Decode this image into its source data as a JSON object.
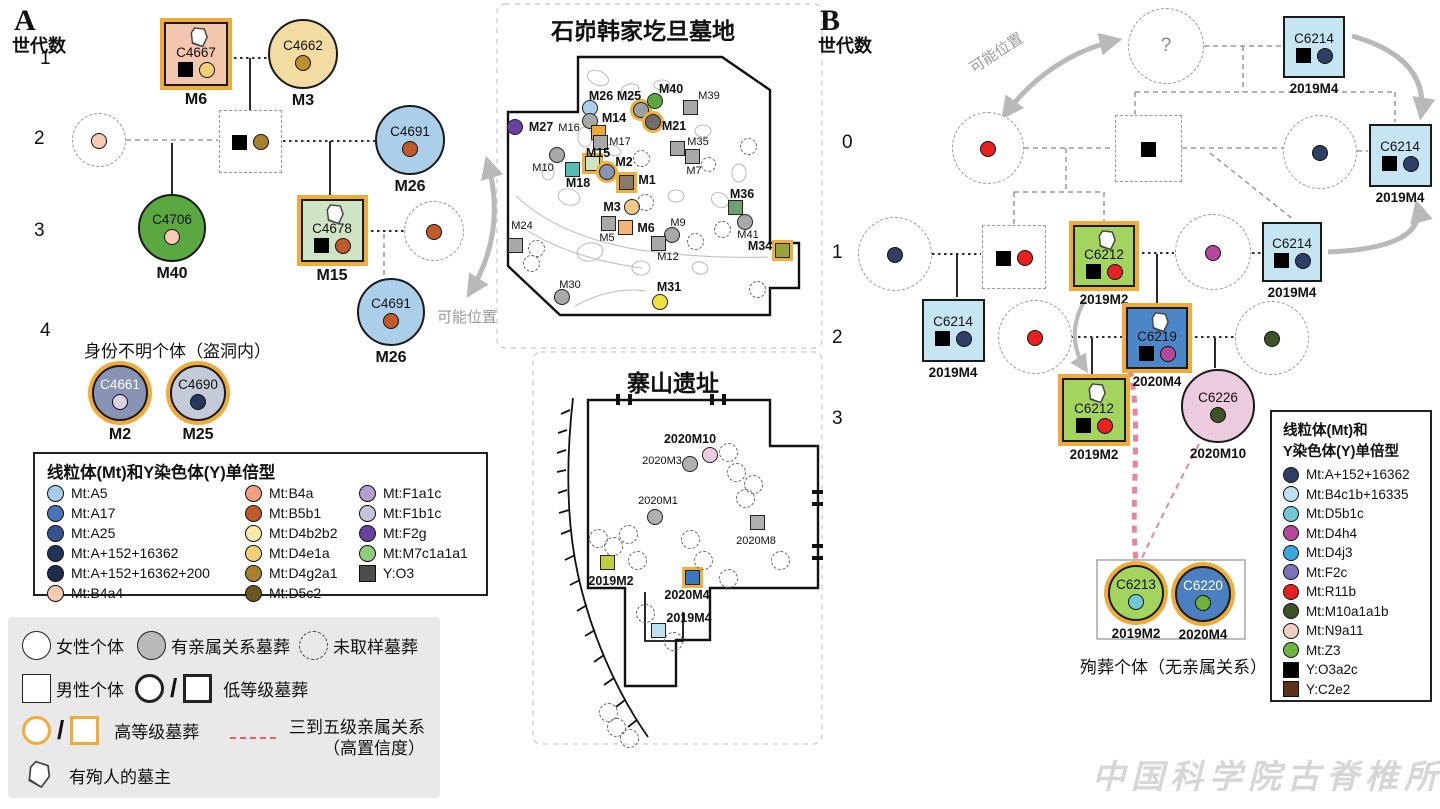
{
  "panelA": {
    "letter": "A",
    "axis_label": "世代数",
    "generations": [
      "1",
      "2",
      "3",
      "4"
    ],
    "unknown_group_label": "身份不明个体（盗洞内）",
    "possible_position_label": "可能位置"
  },
  "panelB": {
    "letter": "B",
    "axis_label": "世代数",
    "generations": [
      "0",
      "1",
      "2",
      "3"
    ],
    "possible_position_label": "可能位置",
    "sacrifice_caption": "殉葬个体（无亲属关系）"
  },
  "nodesA": [
    {
      "id": "C4667",
      "tomb": "M6",
      "shape": "sq",
      "x": 196,
      "y": 54,
      "s": 64,
      "fill": "#f3c6ae",
      "ring": true,
      "jar": true,
      "ysq": true,
      "dot": "#f2d176"
    },
    {
      "id": "C4662",
      "tomb": "M3",
      "shape": "ci",
      "x": 303,
      "y": 54,
      "s": 70,
      "fill": "#f3dca2",
      "dot": "#bd8e2e"
    },
    {
      "shape": "ci",
      "dashed": true,
      "x": 99,
      "y": 140,
      "s": 54,
      "dot": "#f7cab3"
    },
    {
      "shape": "sq",
      "dashed": true,
      "x": 250,
      "y": 141,
      "s": 63,
      "ysq": true,
      "dot": "#a9802e"
    },
    {
      "id": "C4691",
      "tomb": "M26",
      "shape": "ci",
      "x": 410,
      "y": 140,
      "s": 70,
      "fill": "#abceeb",
      "dot": "#c15a2a"
    },
    {
      "id": "C4706",
      "tomb": "M40",
      "shape": "ci",
      "x": 172,
      "y": 228,
      "s": 68,
      "fill": "#5aa83f",
      "dot": "#f7cab3"
    },
    {
      "id": "C4678",
      "tomb": "M15",
      "shape": "sq",
      "x": 332,
      "y": 230,
      "s": 63,
      "fill": "#cfe4c5",
      "ring": true,
      "jar": true,
      "ysq": true,
      "dot": "#c15a2a"
    },
    {
      "shape": "ci",
      "dashed": true,
      "x": 434,
      "y": 231,
      "s": 60,
      "dot": "#c15a2a"
    },
    {
      "id": "C4691",
      "tomb": "M26",
      "shape": "ci",
      "x": 391,
      "y": 312,
      "s": 68,
      "fill": "#abceeb",
      "dot": "#c15a2a"
    },
    {
      "id": "C4661",
      "tomb": "M2",
      "shape": "ci",
      "x": 120,
      "y": 393,
      "s": 56,
      "fill": "#8893b6",
      "ring": true,
      "dot": "#d9d2e4",
      "light": true
    },
    {
      "id": "C4690",
      "tomb": "M25",
      "shape": "ci",
      "x": 198,
      "y": 393,
      "s": 56,
      "fill": "#c4cbd8",
      "ring": true,
      "dot": "#26365c"
    }
  ],
  "nodesB": [
    {
      "q": "?",
      "shape": "ci",
      "dashed": true,
      "x": 1166,
      "y": 46,
      "s": 76
    },
    {
      "id": "C6214",
      "tomb": "2019M4",
      "shape": "sq",
      "x": 1314,
      "y": 47,
      "s": 62,
      "fill": "#c6e5f3",
      "ysq": true,
      "dot": "#2e3f66"
    },
    {
      "shape": "ci",
      "dashed": true,
      "x": 988,
      "y": 148,
      "s": 72,
      "dot": "#e8201f"
    },
    {
      "shape": "sq",
      "dashed": true,
      "x": 1148,
      "y": 148,
      "s": 67,
      "ysq": true
    },
    {
      "shape": "ci",
      "dashed": true,
      "x": 1320,
      "y": 152,
      "s": 74,
      "dot": "#2e3f66"
    },
    {
      "id": "C6214",
      "tomb": "2019M4",
      "shape": "sq",
      "x": 1400,
      "y": 155,
      "s": 63,
      "fill": "#c6e5f3",
      "ysq": true,
      "dot": "#2e3f66"
    },
    {
      "shape": "ci",
      "dashed": true,
      "x": 895,
      "y": 254,
      "s": 74,
      "dot": "#2e3f66"
    },
    {
      "shape": "sq",
      "dashed": true,
      "x": 1014,
      "y": 257,
      "s": 64,
      "ysq": true,
      "dot": "#e8201f"
    },
    {
      "id": "C6212",
      "tomb": "2019M2",
      "shape": "sq",
      "x": 1104,
      "y": 256,
      "s": 62,
      "fill": "#a2d45e",
      "ring": true,
      "jar": true,
      "ysq": true,
      "dot": "#e8201f"
    },
    {
      "shape": "ci",
      "dashed": true,
      "x": 1213,
      "y": 252,
      "s": 76,
      "dot": "#b5489b"
    },
    {
      "id": "C6214",
      "tomb": "2019M4",
      "shape": "sq",
      "x": 1292,
      "y": 252,
      "s": 60,
      "fill": "#c6e5f3",
      "ysq": true,
      "dot": "#2e3f66"
    },
    {
      "id": "C6214",
      "tomb": "2019M4",
      "shape": "sq",
      "x": 953,
      "y": 330,
      "s": 63,
      "fill": "#c6e5f3",
      "ysq": true,
      "dot": "#2e3f66"
    },
    {
      "shape": "ci",
      "dashed": true,
      "x": 1035,
      "y": 337,
      "s": 74,
      "dot": "#e8201f"
    },
    {
      "id": "C6219",
      "tomb": "2020M4",
      "shape": "sq",
      "x": 1157,
      "y": 338,
      "s": 62,
      "fill": "#4a86c8",
      "ring": true,
      "jar": true,
      "ysq": true,
      "dot": "#b5489b"
    },
    {
      "shape": "ci",
      "dashed": true,
      "x": 1272,
      "y": 338,
      "s": 74,
      "dot": "#3f5328"
    },
    {
      "id": "C6226",
      "tomb": "2020M10",
      "shape": "ci",
      "x": 1218,
      "y": 406,
      "s": 74,
      "fill": "#edcbdf",
      "dot": "#3f5328"
    },
    {
      "id": "C6212",
      "tomb": "2019M2",
      "shape": "sq",
      "x": 1094,
      "y": 410,
      "s": 64,
      "fill": "#a2d45e",
      "ring": true,
      "jar": true,
      "ysq": true,
      "dot": "#e8201f"
    },
    {
      "id": "C6213",
      "tomb": "2019M2",
      "shape": "ci",
      "x": 1136,
      "y": 593,
      "s": 56,
      "fill": "#a2d45e",
      "ring": true,
      "dot": "#6fc9d4"
    },
    {
      "id": "C6220",
      "tomb": "2020M4",
      "shape": "ci",
      "x": 1203,
      "y": 594,
      "s": 56,
      "fill": "#4a7fc0",
      "ring": true,
      "dot": "#6db33f",
      "light": true
    }
  ],
  "mapA": {
    "title": "石峁韩家圪旦墓地",
    "markers": [
      {
        "id": "M26",
        "shape": "ci",
        "x": 590,
        "y": 108,
        "fill": "#abceeb",
        "lx": 601,
        "ly": 96,
        "bold": true
      },
      {
        "id": "M25",
        "shape": "ci",
        "x": 641,
        "y": 110,
        "fill": "#9aa0a6",
        "ring": true,
        "lx": 629,
        "ly": 96,
        "bold": true
      },
      {
        "id": "M40",
        "shape": "ci",
        "x": 655,
        "y": 101,
        "fill": "#5aa83f",
        "lx": 671,
        "ly": 89,
        "bold": true
      },
      {
        "id": "M39",
        "shape": "sq",
        "x": 690,
        "y": 107,
        "fill": "#a8a8a8",
        "lx": 709,
        "ly": 96
      },
      {
        "id": "M27",
        "shape": "ci",
        "x": 515,
        "y": 127,
        "fill": "#6a3f9e",
        "lx": 541,
        "ly": 127,
        "bold": true
      },
      {
        "id": "M16",
        "shape": "ci",
        "x": 590,
        "y": 121,
        "fill": "#a8a8a8",
        "lx": 569,
        "ly": 128
      },
      {
        "id": "M14",
        "shape": "sq",
        "x": 598,
        "y": 132,
        "fill": "#f0a832",
        "lx": 614,
        "ly": 118,
        "bold": true
      },
      {
        "id": "M17",
        "shape": "sq",
        "x": 600,
        "y": 142,
        "fill": "#a8a8a8",
        "lx": 620,
        "ly": 142
      },
      {
        "id": "M21",
        "shape": "ci",
        "x": 653,
        "y": 122,
        "fill": "#6e6e6e",
        "ring": true,
        "lx": 674,
        "ly": 126,
        "bold": true
      },
      {
        "id": "M35",
        "shape": "sq",
        "x": 677,
        "y": 148,
        "fill": "#a8a8a8",
        "lx": 698,
        "ly": 142
      },
      {
        "id": "",
        "shape": "sq",
        "x": 692,
        "y": 156,
        "fill": "#a8a8a8",
        "lx": 0,
        "ly": 0
      },
      {
        "id": "M15",
        "shape": "sq",
        "x": 592,
        "y": 163,
        "fill": "#cfe4c5",
        "ring": true,
        "lx": 598,
        "ly": 153,
        "bold": true
      },
      {
        "id": "M2",
        "shape": "ci",
        "x": 607,
        "y": 172,
        "fill": "#8893b6",
        "ring": true,
        "lx": 624,
        "ly": 162,
        "bold": true
      },
      {
        "id": "M10",
        "shape": "ci",
        "x": 557,
        "y": 155,
        "fill": "#a8a8a8",
        "lx": 543,
        "ly": 168
      },
      {
        "id": "M18",
        "shape": "sq",
        "x": 572,
        "y": 169,
        "fill": "#57bdb2",
        "lx": 578,
        "ly": 183,
        "bold": true
      },
      {
        "id": "M1",
        "shape": "sq",
        "x": 626,
        "y": 182,
        "fill": "#8a7a6a",
        "ring": true,
        "lx": 647,
        "ly": 180,
        "bold": true
      },
      {
        "id": "M7",
        "shape": "dash",
        "x": 708,
        "y": 164,
        "lx": 694,
        "ly": 171
      },
      {
        "id": "M36",
        "shape": "sq",
        "x": 735,
        "y": 207,
        "fill": "#6f9e6f",
        "lx": 742,
        "ly": 194,
        "bold": true
      },
      {
        "id": "M3",
        "shape": "ci",
        "x": 632,
        "y": 207,
        "fill": "#f5c98a",
        "lx": 612,
        "ly": 207,
        "bold": true
      },
      {
        "id": "M24",
        "shape": "sq",
        "x": 515,
        "y": 245,
        "fill": "#a8a8a8",
        "lx": 522,
        "ly": 226
      },
      {
        "id": "M5",
        "shape": "sq",
        "x": 608,
        "y": 223,
        "fill": "#a8a8a8",
        "lx": 607,
        "ly": 238
      },
      {
        "id": "M6",
        "shape": "sq",
        "x": 625,
        "y": 227,
        "fill": "#f5b57a",
        "lx": 646,
        "ly": 228,
        "bold": true
      },
      {
        "id": "M9",
        "shape": "ci",
        "x": 672,
        "y": 235,
        "fill": "#a8a8a8",
        "lx": 678,
        "ly": 223
      },
      {
        "id": "M12",
        "shape": "sq",
        "x": 658,
        "y": 243,
        "fill": "#a8a8a8",
        "lx": 668,
        "ly": 257
      },
      {
        "id": "M41",
        "shape": "ci",
        "x": 745,
        "y": 222,
        "fill": "#a8a8a8",
        "lx": 748,
        "ly": 235
      },
      {
        "id": "M34",
        "shape": "sq",
        "x": 782,
        "y": 250,
        "fill": "#9aa23a",
        "ring": true,
        "lx": 760,
        "ly": 246,
        "bold": true
      },
      {
        "id": "M30",
        "shape": "ci",
        "x": 562,
        "y": 297,
        "fill": "#a8a8a8",
        "lx": 570,
        "ly": 285
      },
      {
        "id": "M31",
        "shape": "ci",
        "x": 660,
        "y": 302,
        "fill": "#f0e13c",
        "lx": 669,
        "ly": 287,
        "bold": true
      }
    ],
    "unsampled": [
      [
        748,
        146
      ],
      [
        641,
        158
      ],
      [
        645,
        202
      ],
      [
        695,
        241
      ],
      [
        536,
        248
      ],
      [
        531,
        263
      ],
      [
        757,
        289
      ],
      [
        722,
        229
      ]
    ]
  },
  "mapB": {
    "title": "寨山遗址",
    "markers": [
      {
        "id": "2020M10",
        "shape": "ci",
        "x": 710,
        "y": 455,
        "fill": "#edcbdf",
        "lx": 690,
        "ly": 439,
        "bold": true
      },
      {
        "id": "2020M3",
        "shape": "ci",
        "x": 690,
        "y": 464,
        "fill": "#b0b0b0",
        "lx": 662,
        "ly": 461
      },
      {
        "id": "2020M1",
        "shape": "ci",
        "x": 655,
        "y": 517,
        "fill": "#b0b0b0",
        "lx": 658,
        "ly": 501
      },
      {
        "id": "2020M8",
        "shape": "sq",
        "x": 757,
        "y": 522,
        "fill": "#b0b0b0",
        "lx": 756,
        "ly": 541
      },
      {
        "id": "2019M2",
        "shape": "sq",
        "x": 607,
        "y": 562,
        "fill": "#c3ce3f",
        "lx": 611,
        "ly": 581,
        "bold": true
      },
      {
        "id": "2020M4",
        "shape": "sq",
        "x": 692,
        "y": 577,
        "fill": "#3a77c2",
        "ring": true,
        "lx": 687,
        "ly": 595,
        "bold": true
      },
      {
        "id": "2019M4",
        "shape": "sq",
        "x": 658,
        "y": 630,
        "fill": "#bfe0ee",
        "lx": 689,
        "ly": 618,
        "bold": true
      }
    ],
    "unsampled": [
      [
        728,
        452
      ],
      [
        736,
        472
      ],
      [
        753,
        484
      ],
      [
        745,
        498
      ],
      [
        598,
        538
      ],
      [
        613,
        546
      ],
      [
        628,
        534
      ],
      [
        637,
        560
      ],
      [
        690,
        539
      ],
      [
        703,
        560
      ],
      [
        780,
        560
      ],
      [
        728,
        578
      ],
      [
        645,
        613
      ],
      [
        673,
        641
      ],
      [
        608,
        712
      ],
      [
        616,
        727
      ],
      [
        629,
        738
      ]
    ]
  },
  "legendA": {
    "title": "线粒体(Mt)和Y染色体(Y)单倍型",
    "columns": [
      [
        {
          "label": "Mt:A5",
          "color": "#a8cbea",
          "shape": "circle"
        },
        {
          "label": "Mt:A17",
          "color": "#4a74b8",
          "shape": "circle"
        },
        {
          "label": "Mt:A25",
          "color": "#35548f",
          "shape": "circle"
        },
        {
          "label": "Mt:A+152+16362",
          "color": "#22335c",
          "shape": "circle"
        },
        {
          "label": "Mt:A+152+16362+200",
          "color": "#1d2b4d",
          "shape": "circle"
        },
        {
          "label": "Mt:B4a4",
          "color": "#f7cab3",
          "shape": "circle"
        }
      ],
      [
        {
          "label": "Mt:B4a",
          "color": "#f0a080",
          "shape": "circle"
        },
        {
          "label": "Mt:B5b1",
          "color": "#c15a2a",
          "shape": "circle"
        },
        {
          "label": "Mt:D4b2b2",
          "color": "#fbe9a8",
          "shape": "circle"
        },
        {
          "label": "Mt:D4e1a",
          "color": "#f2d176",
          "shape": "circle"
        },
        {
          "label": "Mt:D4g2a1",
          "color": "#a9802e",
          "shape": "circle"
        },
        {
          "label": "Mt:D5c2",
          "color": "#6b5722",
          "shape": "circle"
        }
      ],
      [
        {
          "label": "Mt:F1a1c",
          "color": "#b49fd1",
          "shape": "circle"
        },
        {
          "label": "Mt:F1b1c",
          "color": "#c8c3dc",
          "shape": "circle"
        },
        {
          "label": "Mt:F2g",
          "color": "#6a3f9e",
          "shape": "circle"
        },
        {
          "label": "Mt:M7c1a1a1",
          "color": "#8fce7a",
          "shape": "circle"
        },
        {
          "label": "Y:O3",
          "color": "#4d4d4d",
          "shape": "square"
        }
      ]
    ]
  },
  "legendB": {
    "title_line1": "线粒体(Mt)和",
    "title_line2": "Y染色体(Y)单倍型",
    "items": [
      {
        "label": "Mt:A+152+16362",
        "color": "#2e3f66",
        "shape": "circle"
      },
      {
        "label": "Mt:B4c1b+16335",
        "color": "#bfe0ee",
        "shape": "circle"
      },
      {
        "label": "Mt:D5b1c",
        "color": "#6fc9d4",
        "shape": "circle"
      },
      {
        "label": "Mt:D4h4",
        "color": "#b5489b",
        "shape": "circle"
      },
      {
        "label": "Mt:D4j3",
        "color": "#3aa8e0",
        "shape": "circle"
      },
      {
        "label": "Mt:F2c",
        "color": "#7b74b8",
        "shape": "circle"
      },
      {
        "label": "Mt:R11b",
        "color": "#e8201f",
        "shape": "circle"
      },
      {
        "label": "Mt:M10a1a1b",
        "color": "#3f5328",
        "shape": "circle"
      },
      {
        "label": "Mt:N9a11",
        "color": "#f2cfc0",
        "shape": "circle"
      },
      {
        "label": "Mt:Z3",
        "color": "#6db33f",
        "shape": "circle"
      },
      {
        "label": "Y:O3a2c",
        "color": "#000000",
        "shape": "square"
      },
      {
        "label": "Y:C2e2",
        "color": "#5c3317",
        "shape": "square"
      }
    ]
  },
  "symbolLegend": {
    "female": "女性个体",
    "related": "有亲属关系墓葬",
    "unsampled": "未取样墓葬",
    "male": "男性个体",
    "low_grade": "低等级墓葬",
    "high_grade": "高等级墓葬",
    "kinship": "三到五级亲属关系",
    "kinship_confidence": "（高置信度）",
    "jar_owner": "有殉人的墓主"
  },
  "watermark": "中国科学院古脊椎所"
}
